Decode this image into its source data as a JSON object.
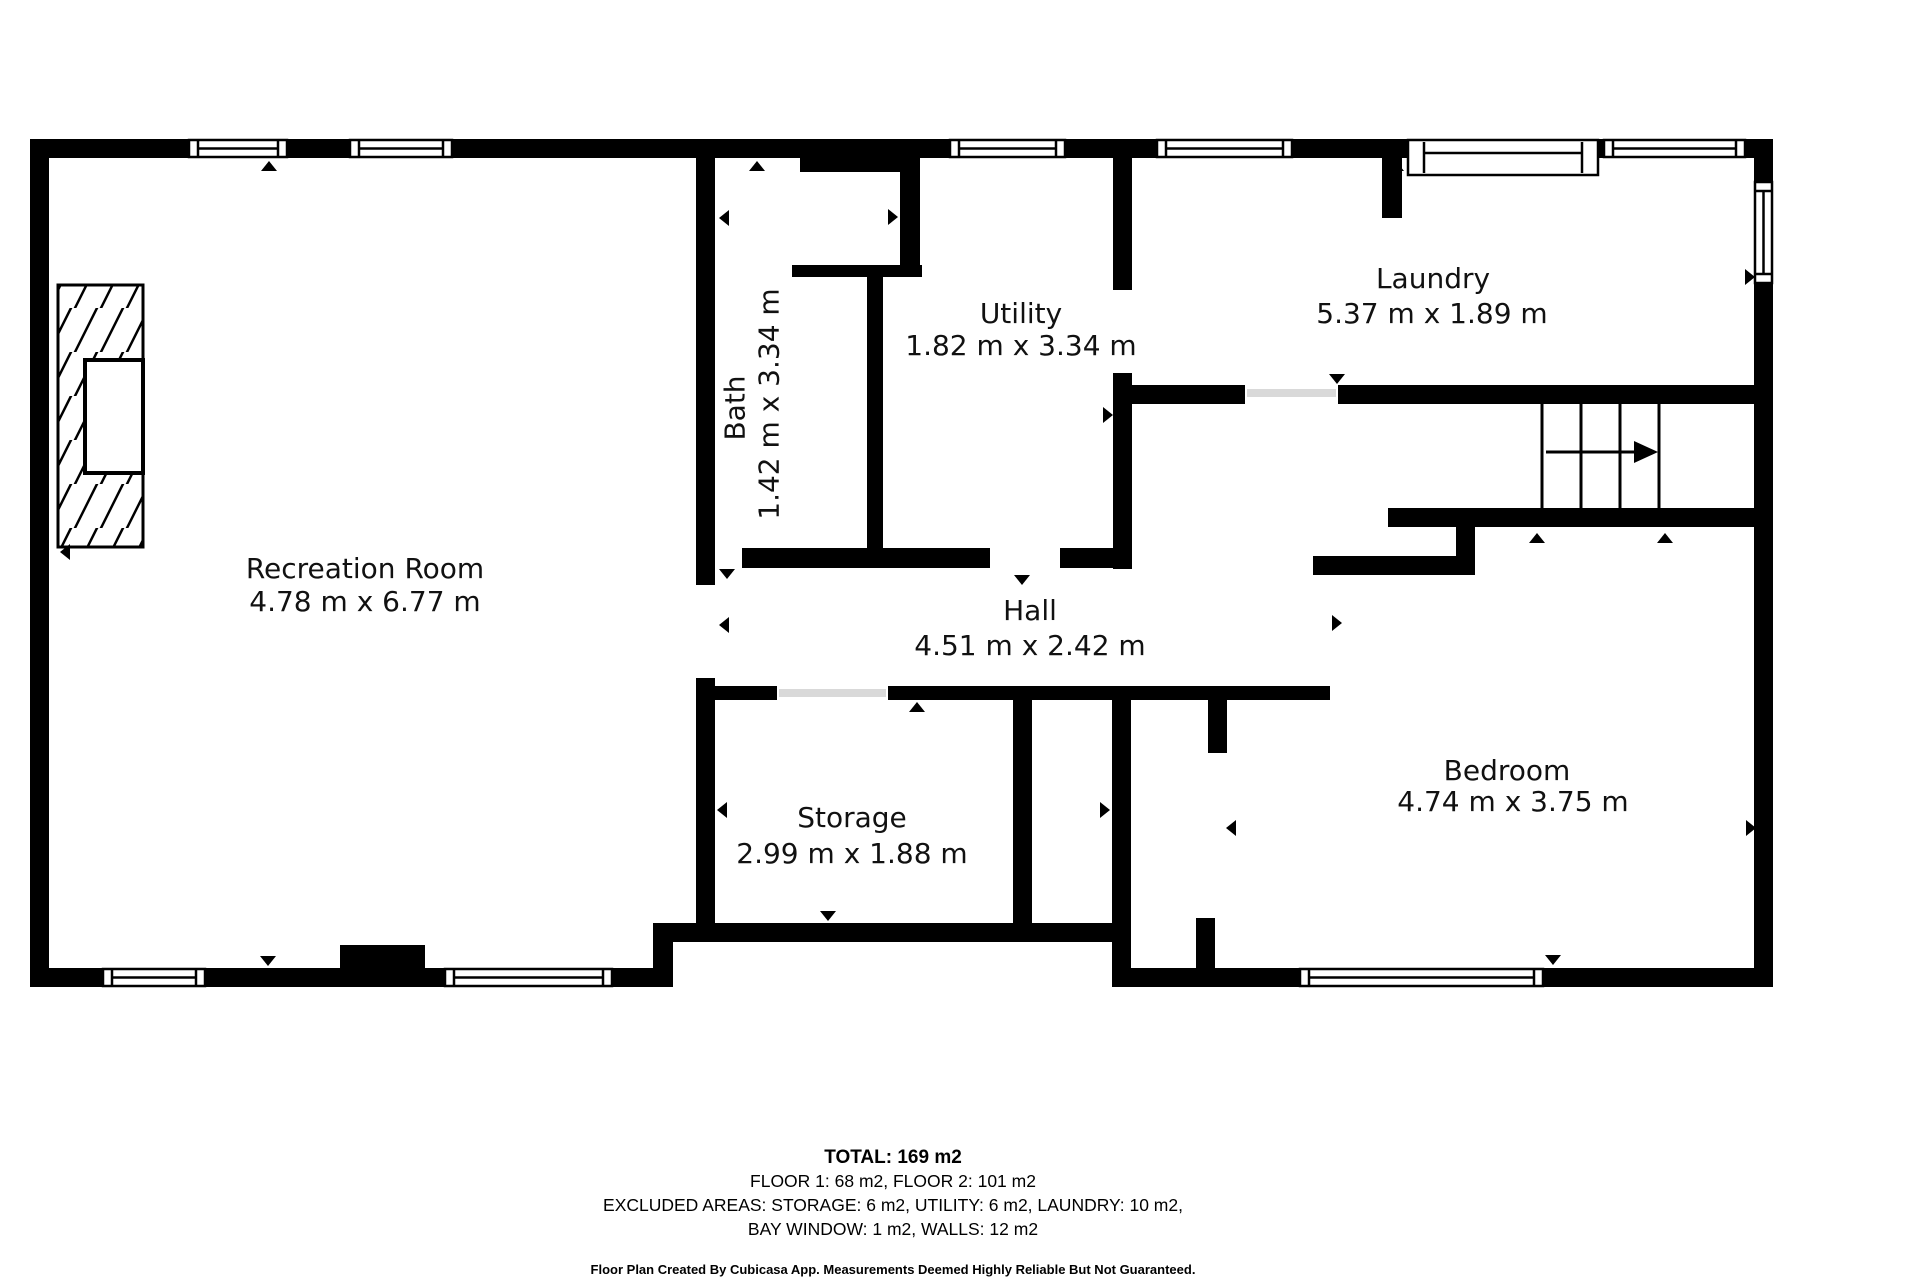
{
  "plan": {
    "wall_color": "#000000",
    "background_color": "#ffffff",
    "text_color": "#111111",
    "rooms": [
      {
        "id": "recreation",
        "name": "Recreation Room",
        "dims": "4.78 m x 6.77 m"
      },
      {
        "id": "bath",
        "name": "Bath",
        "dims": "1.42 m x 3.34 m"
      },
      {
        "id": "utility",
        "name": "Utility",
        "dims": "1.82 m x 3.34 m"
      },
      {
        "id": "laundry",
        "name": "Laundry",
        "dims": "5.37 m x 1.89 m"
      },
      {
        "id": "hall",
        "name": "Hall",
        "dims": "4.51 m x 2.42 m"
      },
      {
        "id": "storage",
        "name": "Storage",
        "dims": "2.99 m x 1.88 m"
      },
      {
        "id": "bedroom",
        "name": "Bedroom",
        "dims": "4.74 m x 3.75 m"
      }
    ]
  },
  "footer": {
    "total": "TOTAL: 169 m2",
    "floors": "FLOOR 1: 68 m2, FLOOR 2: 101 m2",
    "excluded_line1": "EXCLUDED AREAS: STORAGE: 6 m2, UTILITY: 6 m2, LAUNDRY: 10 m2,",
    "excluded_line2": "BAY WINDOW: 1 m2, WALLS: 12 m2",
    "disclaimer": "Floor Plan Created By Cubicasa App. Measurements Deemed Highly Reliable But Not Guaranteed."
  }
}
